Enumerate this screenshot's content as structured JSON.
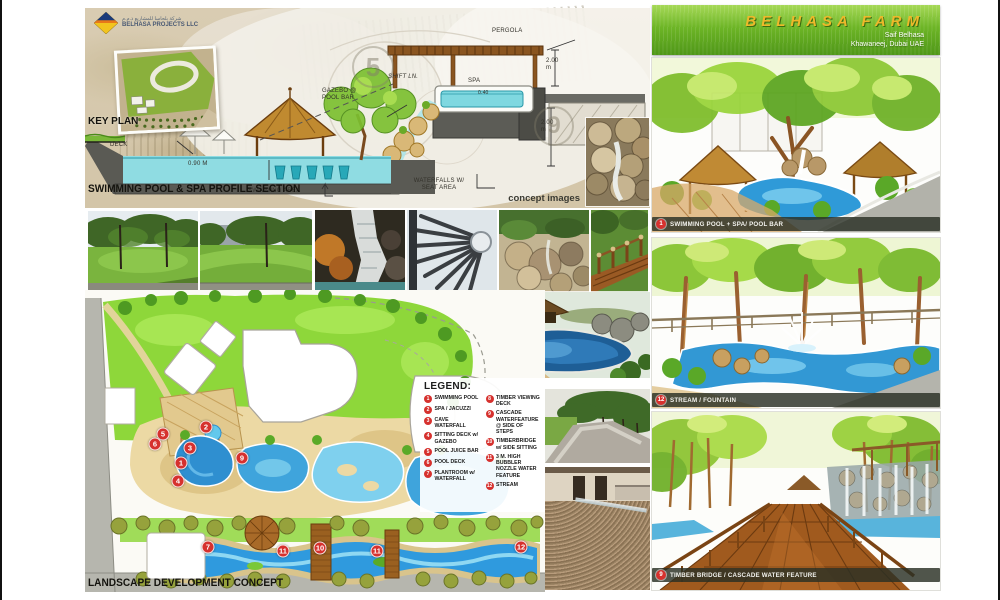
{
  "board": {
    "logo": {
      "arabic": "شركة بلحاسا للمشاريع ذ.م.م",
      "company": "BELHASA PROJECTS LLC"
    },
    "key_plan": {
      "label": "KEY PLAN"
    },
    "section": {
      "title": "SWIMMING POOL & SPA PROFILE SECTION",
      "watermark_5": "5",
      "watermark_9": "9",
      "labels": {
        "pergola": "PERGOLA",
        "dim_upper": "2.00 m",
        "dim_lower": "2.00 m",
        "shift_line": "SHIFT LN.",
        "spa": "SPA",
        "spa_depth": "0.40",
        "gazebo": "GAZEBO @ POOL BAR",
        "deck": "DECK",
        "pool_depth": "0.90 M",
        "swimming_area": "SWIMMING AREA",
        "waterfalls": "WATERFALLS W/ SEAT AREA"
      }
    },
    "concept_images_label": "concept images",
    "legend": {
      "title": "LEGEND:",
      "items": [
        {
          "num": "1",
          "label": "SWIMMING POOL"
        },
        {
          "num": "2",
          "label": "SPA / JACUZZI"
        },
        {
          "num": "3",
          "label": "CAVE WATERFALL"
        },
        {
          "num": "4",
          "label": "SITTING DECK w/ GAZEBO"
        },
        {
          "num": "5",
          "label": "POOL JUICE BAR"
        },
        {
          "num": "6",
          "label": "POOL DECK"
        },
        {
          "num": "7",
          "label": "PLANTROOM w/ WATERFALL"
        },
        {
          "num": "8",
          "label": "TIMBER VIEWING DECK"
        },
        {
          "num": "9",
          "label": "CASCADE WATERFEATURE @ SIDE OF STEPS"
        },
        {
          "num": "10",
          "label": "TIMBERBRIDGE w/ SIDE SITTING"
        },
        {
          "num": "11",
          "label": "3 M. HIGH BUBBLER NOZZLE WATER FEATURE"
        },
        {
          "num": "12",
          "label": "STREAM"
        }
      ]
    },
    "plan": {
      "title": "LANDSCAPE DEVELOPMENT CONCEPT",
      "markers": [
        {
          "num": "5"
        },
        {
          "num": "2"
        },
        {
          "num": "6"
        },
        {
          "num": "3"
        },
        {
          "num": "1"
        },
        {
          "num": "4"
        },
        {
          "num": "9"
        },
        {
          "num": "7"
        },
        {
          "num": "11"
        },
        {
          "num": "10"
        },
        {
          "num": "11"
        },
        {
          "num": "12"
        }
      ]
    },
    "header": {
      "title": "BELHASA FARM",
      "client": "Saif Belhasa",
      "location": "Khawaneej, Dubai UAE"
    },
    "renders": [
      {
        "num": "1",
        "caption": "SWIMMING POOL + SPA/ POOL BAR"
      },
      {
        "num": "12",
        "caption": "STREAM / FOUNTAIN"
      },
      {
        "num": "9",
        "caption": "TIMBER BRIDGE / CASCADE WATER FEATURE"
      }
    ],
    "colors": {
      "header_green": "#63ad21",
      "title_gold": "#edba2a",
      "marker_red": "#d6312e",
      "water_blue": "#3a9ad8",
      "lawn_green": "#8ed73a",
      "sand_tan": "#ecd9a4",
      "road_gray": "#b6b6ae"
    }
  }
}
